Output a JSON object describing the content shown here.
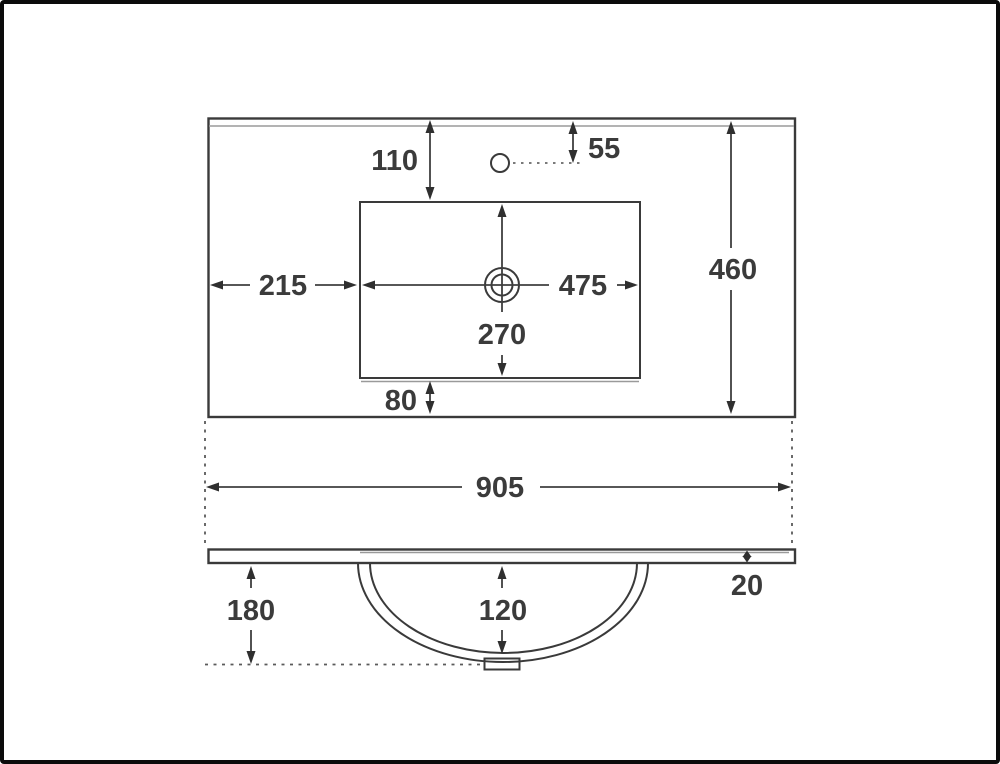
{
  "drawing": {
    "background": "#ffffff",
    "frame_color": "#0b0b0b",
    "line_color": "#3a3a3a",
    "secondary_line_color": "#9a9a9a",
    "text_color": "#3b3b3b",
    "dims": {
      "cutout_from_back": "110",
      "tap_hole_from_back": "55",
      "cutout_from_left": "215",
      "cutout_width": "475",
      "cutout_depth": "270",
      "cutout_from_front": "80",
      "overall_depth": "460",
      "overall_width": "905",
      "top_thickness": "20",
      "underside_height": "180",
      "bowl_depth": "120"
    }
  }
}
